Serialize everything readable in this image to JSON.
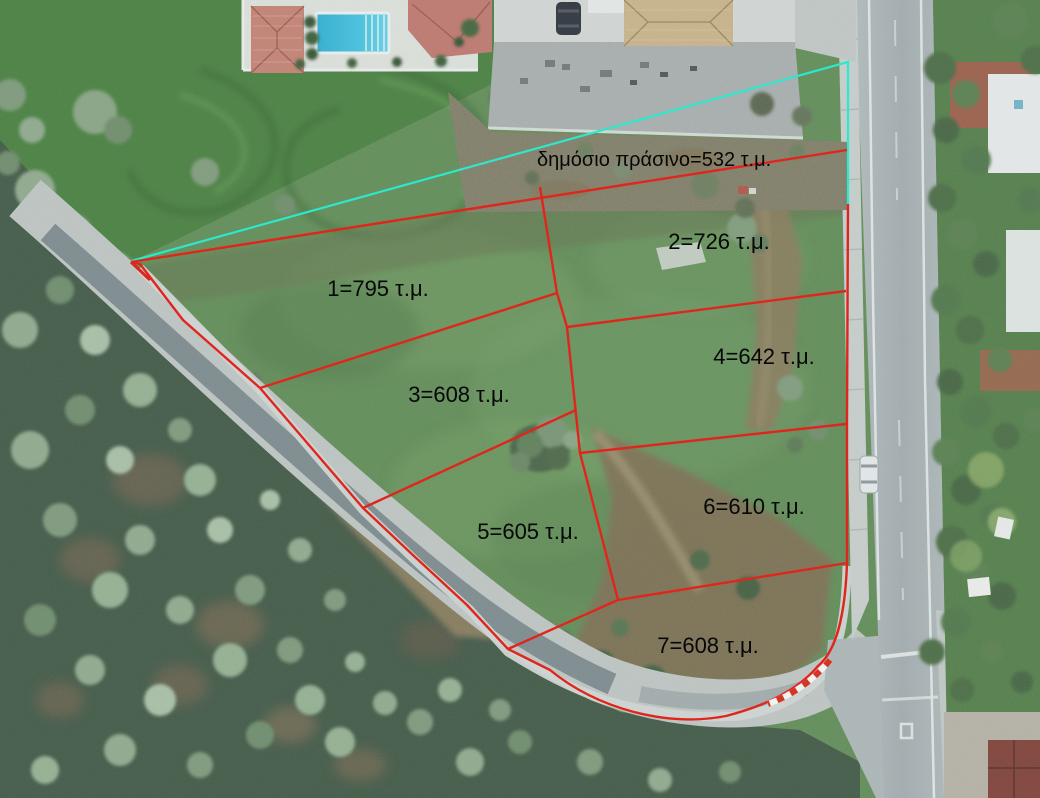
{
  "scene": {
    "description": "Drone aerial photograph of a field subdivided into 7 numbered building plots plus a public green strip, marked with red cadastral boundary lines and one cyan survey line; a curved rural road borders the site on the left and bottom and a straight asphalt road runs along the right side.",
    "colors": {
      "parcel_line": "#e0261c",
      "survey_line": "#2ce8cd",
      "label_text": "#070707",
      "field_green": "#5e8a52",
      "road_gray": "#b5bcbb",
      "pool_blue": "#2fb5d8"
    }
  },
  "units": "τ.μ.",
  "parcels": [
    {
      "id": "public-green",
      "name": "δημόσιο πράσινο",
      "area_sqm": 532,
      "label": "δημόσιο πράσινο=532 τ.μ."
    },
    {
      "id": "1",
      "area_sqm": 795,
      "label": "1=795 τ.μ."
    },
    {
      "id": "2",
      "area_sqm": 726,
      "label": "2=726 τ.μ."
    },
    {
      "id": "3",
      "area_sqm": 608,
      "label": "3=608 τ.μ."
    },
    {
      "id": "4",
      "area_sqm": 642,
      "label": "4=642 τ.μ."
    },
    {
      "id": "5",
      "area_sqm": 605,
      "label": "5=605 τ.μ."
    },
    {
      "id": "6",
      "area_sqm": 610,
      "label": "6=610 τ.μ."
    },
    {
      "id": "7",
      "area_sqm": 608,
      "label": "7=608 τ.μ."
    }
  ]
}
